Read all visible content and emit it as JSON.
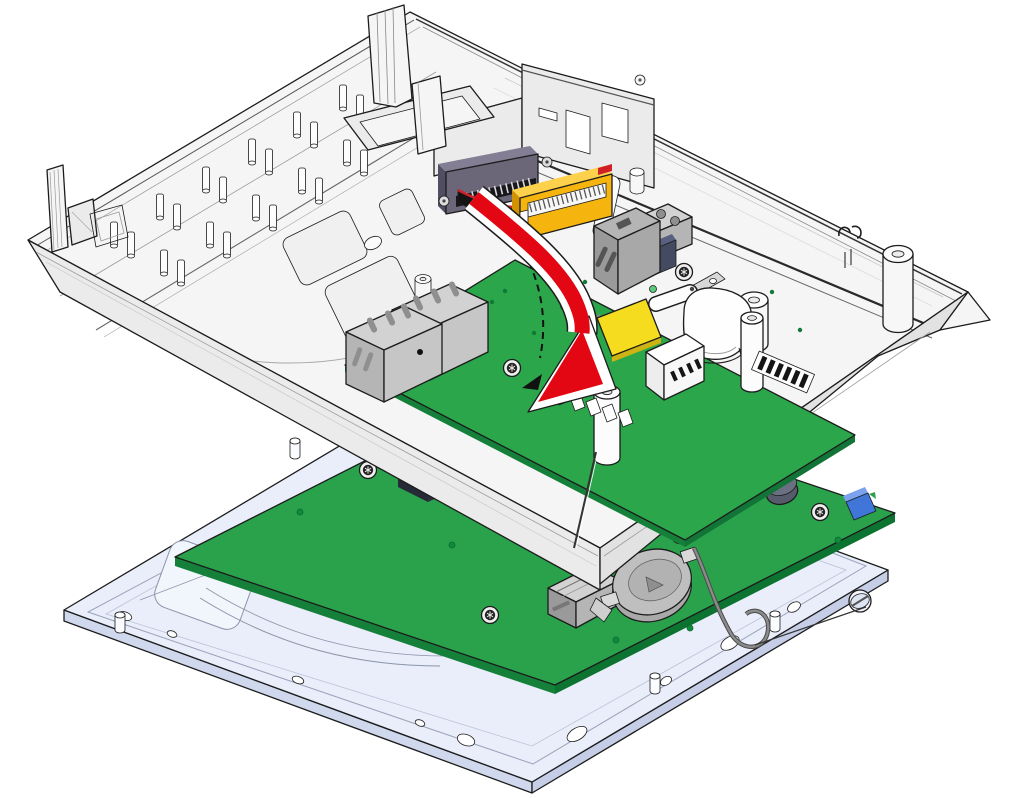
{
  "figure": {
    "type": "technical-illustration",
    "subject": "Circuit board installation into device rear housing",
    "description": "Exploded assembly drawing: a green control circuit board is lowered into the white rear housing of a device, shown by a thick red curved arrow with a dashed motion path. Below, a pale-blue display frame carries a second green circuit board with a coin-cell battery holder and micro-SD card slot."
  },
  "colors": {
    "line": "#1c1c1c",
    "case_light": "#f5f5f5",
    "case_mid": "#ebebeb",
    "case_dark": "#e2e2e2",
    "white": "#ffffff",
    "pcb_green": "#2ba64b",
    "pcb_edge": "#15803a",
    "pcb2_green": "#2aa24c",
    "conn_dark": "#6b6678",
    "conn_dark_top": "#837e93",
    "conn_dark_side": "#514d62",
    "conn_yellow": "#f6b40f",
    "conn_yellow_top": "#fdd14b",
    "conn_yellow_side": "#d29200",
    "cable_black": "#141414",
    "stripe_red": "#cf2127",
    "arrow_red": "#e30613",
    "metal_light": "#d2d2d2",
    "metal_mid": "#b5b5b5",
    "metal_dark": "#9a9a9a",
    "navy": "#444a60",
    "pad_yellow": "#f5dc1f",
    "frame_blue": "#e9eefa",
    "frame_edge": "#cfd8ec",
    "wire_gray": "#8b8b8b",
    "comp_blue": "#3f76d8",
    "green_dot": "#0f7a36"
  },
  "parts": [
    {
      "id": "rear-housing",
      "label": "rear housing"
    },
    {
      "id": "snap-latch",
      "label": "snap latch"
    },
    {
      "id": "guide-pins",
      "label": "guide pins"
    },
    {
      "id": "board-connector",
      "label": "board connector"
    },
    {
      "id": "ffc-connector",
      "label": "FFC connector"
    },
    {
      "id": "ribbon-cable",
      "label": "ribbon cable"
    },
    {
      "id": "control-pcb",
      "label": "control circuit board"
    },
    {
      "id": "modular-jacks",
      "label": "modular jacks"
    },
    {
      "id": "terminal-block",
      "label": "terminal block"
    },
    {
      "id": "buzzer",
      "label": "buzzer"
    },
    {
      "id": "dip-switch",
      "label": "DIP switch"
    },
    {
      "id": "standoffs",
      "label": "standoffs"
    },
    {
      "id": "insertion-arrow",
      "label": "insertion direction arrow"
    },
    {
      "id": "motion-path",
      "label": "dashed motion path"
    },
    {
      "id": "display-frame",
      "label": "display frame"
    },
    {
      "id": "display-pcb",
      "label": "display circuit board"
    },
    {
      "id": "coin-cell-holder",
      "label": "coin cell holder"
    },
    {
      "id": "micro-sd-slot",
      "label": "micro-SD slot"
    },
    {
      "id": "antenna-wire",
      "label": "antenna wire"
    }
  ]
}
